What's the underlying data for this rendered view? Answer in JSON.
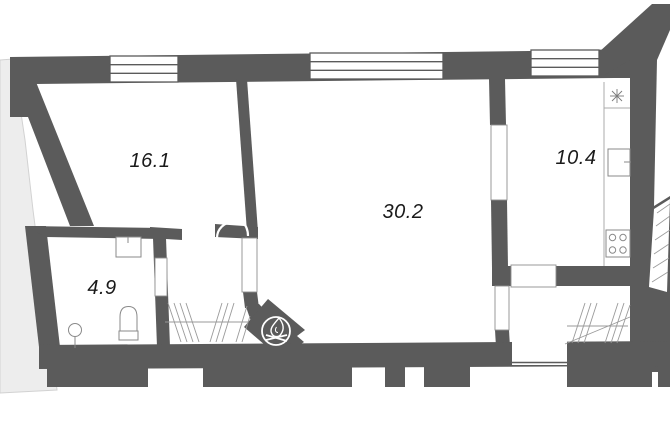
{
  "plan": {
    "title": "apartment-floor-plan",
    "rooms": [
      {
        "id": "living-room",
        "area": "16.1"
      },
      {
        "id": "main-room",
        "area": "30.2"
      },
      {
        "id": "kitchen",
        "area": "10.4"
      },
      {
        "id": "bathroom",
        "area": "4.9"
      }
    ],
    "colors": {
      "wall": "#5b5b5b",
      "background": "#ffffff",
      "neighbor": "#ededed",
      "neighbor_edge": "#d2d2d2",
      "hatch": "#9a9a9a",
      "fixture": "#8a8a8a",
      "counter": "#ababab",
      "label": "#1a1a1a",
      "logo": "#ffffff"
    }
  }
}
